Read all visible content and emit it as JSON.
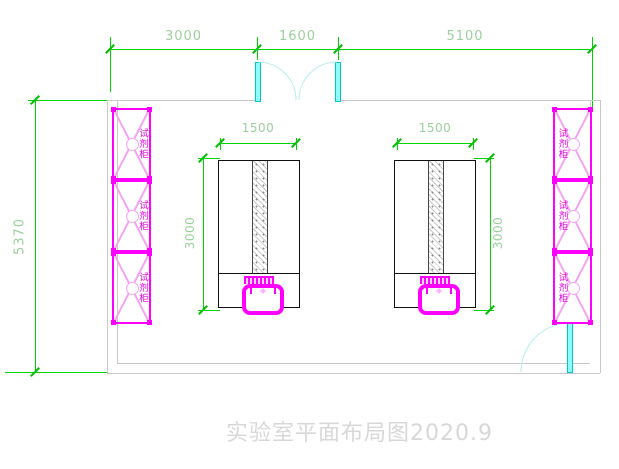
{
  "plan": {
    "title": "实验室平面布局图2020.9",
    "dims": {
      "top": [
        "3000",
        "1600",
        "5100"
      ],
      "left_height": "5370",
      "bench_left_width": "1500",
      "bench_right_width": "1500",
      "bench_left_height": "3000",
      "bench_right_height": "3000"
    },
    "cabinets": {
      "label": "试剂柜",
      "left_count": 3,
      "right_count": 3
    },
    "colors": {
      "dimension_line": "#00d400",
      "dimension_text": "#9ccf9c",
      "cabinet_magenta": "#ff00ff",
      "cabinet_light": "#f2a6f2",
      "door_cyan": "#00e6e6",
      "wall_gray": "#c9c9c9",
      "bench_outline": "#111111",
      "title_gray": "#d8d8d8"
    }
  }
}
